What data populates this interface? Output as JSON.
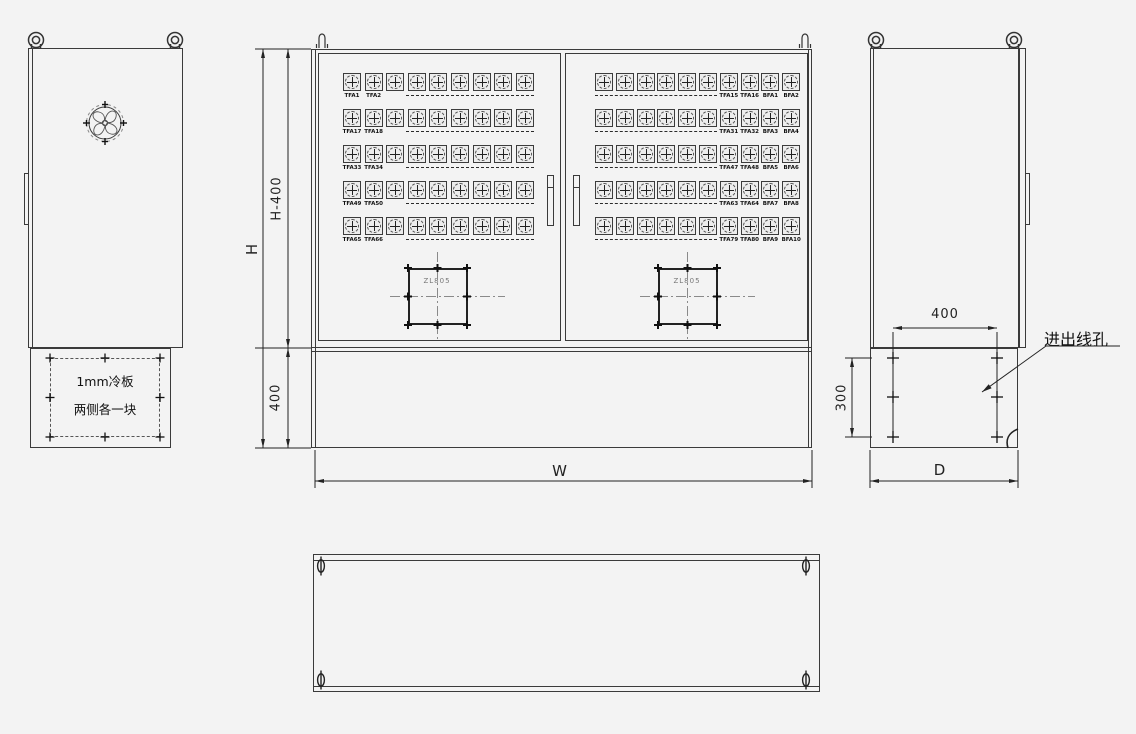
{
  "drawing": {
    "background": "#f3f3f3",
    "line_color": "#3a3a3a",
    "accent_color": "#222222"
  },
  "left_view": {
    "cold_plate_note_line1": "1mm冷板",
    "cold_plate_note_line2": "两侧各一块"
  },
  "front_view": {
    "dim_height_label": "H",
    "dim_height_minus_label": "H-400",
    "dim_skirt_label": "400",
    "dim_width_label": "W",
    "gland_label": "ZL805",
    "connectors_per_row_left_door": 9,
    "connectors_per_row_right_door": 10,
    "rows": [
      {
        "left_labels": [
          "TFA1",
          "TFA2"
        ],
        "right_labels": [
          "TFA15",
          "TFA16",
          "BFA1",
          "BFA2"
        ]
      },
      {
        "left_labels": [
          "TFA17",
          "TFA18"
        ],
        "right_labels": [
          "TFA31",
          "TFA32",
          "BFA3",
          "BFA4"
        ]
      },
      {
        "left_labels": [
          "TFA33",
          "TFA34"
        ],
        "right_labels": [
          "TFA47",
          "TFA48",
          "BFA5",
          "BFA6"
        ]
      },
      {
        "left_labels": [
          "TFA49",
          "TFA50"
        ],
        "right_labels": [
          "TFA63",
          "TFA64",
          "BFA7",
          "BFA8"
        ]
      },
      {
        "left_labels": [
          "TFA65",
          "TFA66"
        ],
        "right_labels": [
          "TFA79",
          "TFA80",
          "BFA9",
          "BFA10"
        ]
      }
    ]
  },
  "side_view": {
    "dim_hole_width": "400",
    "dim_hole_height": "300",
    "dim_depth_label": "D",
    "cable_hole_label": "进出线孔"
  }
}
